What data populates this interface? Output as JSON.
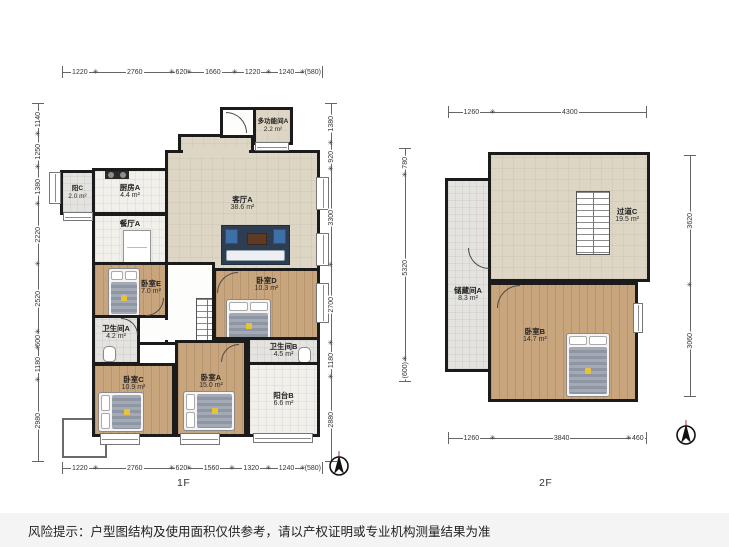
{
  "disclaimer": "风险提示：户型图结构及使用面积仅供参考，请以产权证明或专业机构测量结果为准",
  "colors": {
    "wall": "#1b1b1b",
    "wood_floor": "#c9a57d",
    "living_floor": "#ddd6c4",
    "tile_floor": "#f1f0eb",
    "bath_floor": "#e4e3df",
    "disclaimer_bar": "#f4f4f4",
    "sofa_rug": "#2d3d52",
    "bed_accent": "#e8c33a"
  },
  "icons": {
    "compass": "north-compass-icon",
    "stairs": "stairs-icon",
    "bed": "bed-icon",
    "sofa_set": "sofa-icon",
    "stove": "stove-icon",
    "toilet": "toilet-icon",
    "dining_table": "dining-table-icon",
    "door": "door-arc-icon",
    "window": "window-icon"
  },
  "floor1": {
    "label": "1F",
    "rooms": {
      "multi": {
        "name": "多功能间A",
        "area": "2.2 m²"
      },
      "balcony_c": {
        "name": "阳C",
        "area": "2.0 m²"
      },
      "kitchen": {
        "name": "厨房A",
        "area": "4.4 m²"
      },
      "dining": {
        "name": "餐厅A",
        "area": "7.6 m²"
      },
      "living": {
        "name": "客厅A",
        "area": "38.6 m²"
      },
      "bed_e": {
        "name": "卧室E",
        "area": "7.0 m²"
      },
      "bed_d": {
        "name": "卧室D",
        "area": "10.3 m²"
      },
      "bath_a": {
        "name": "卫生间A",
        "area": "4.2 m²"
      },
      "bath_b": {
        "name": "卫生间B",
        "area": "4.5 m²"
      },
      "bed_c": {
        "name": "卧室C",
        "area": "10.9 m²"
      },
      "bed_a": {
        "name": "卧室A",
        "area": "15.0 m²"
      },
      "balcony_b": {
        "name": "阳台B",
        "area": "6.6 m²"
      }
    },
    "dims": {
      "top": [
        "1220",
        "2760",
        "620",
        "1660",
        "1220",
        "1240",
        "(580)"
      ],
      "bottom": [
        "1220",
        "2760",
        "620",
        "1560",
        "1320",
        "1240",
        "(580)"
      ],
      "left": [
        "1140",
        "1250",
        "1380",
        "2220",
        "2520",
        "600",
        "1180",
        "2980"
      ],
      "right": [
        "1380",
        "920",
        "3300",
        "2700",
        "1180",
        "2880"
      ]
    }
  },
  "floor2": {
    "label": "2F",
    "rooms": {
      "corridor": {
        "name": "过道C",
        "area": "19.5 m²"
      },
      "storage": {
        "name": "储藏间A",
        "area": "8.3 m²"
      },
      "bed_b": {
        "name": "卧室B",
        "area": "14.7 m²"
      }
    },
    "dims": {
      "top": [
        "1260",
        "4300"
      ],
      "bottom": [
        "1260",
        "3840",
        "460"
      ],
      "left": [
        "780",
        "5320",
        "(600)"
      ],
      "right": [
        "3620",
        "3060"
      ]
    }
  }
}
